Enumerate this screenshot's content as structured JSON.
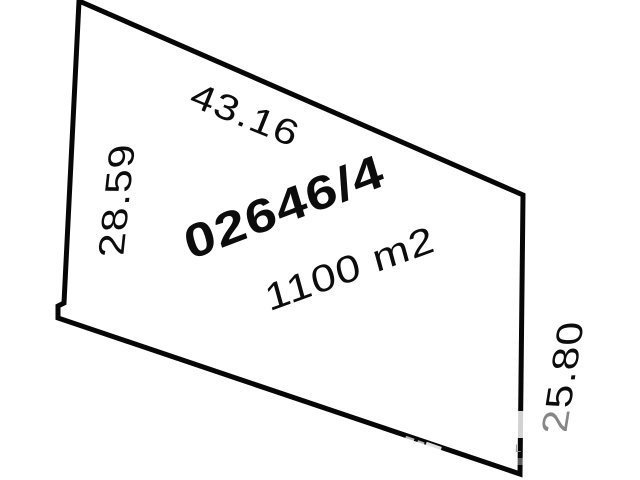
{
  "map": {
    "parcel": {
      "number": "02646/4",
      "area_label": "1100 m2",
      "edge_lengths": {
        "top": "43.16",
        "left": "28.59",
        "right": "25.80"
      }
    },
    "watermark_remnant": "L",
    "colors": {
      "background": "#ffffff",
      "boundary_line": "#070707",
      "label_text": "#0c0c0c"
    }
  }
}
